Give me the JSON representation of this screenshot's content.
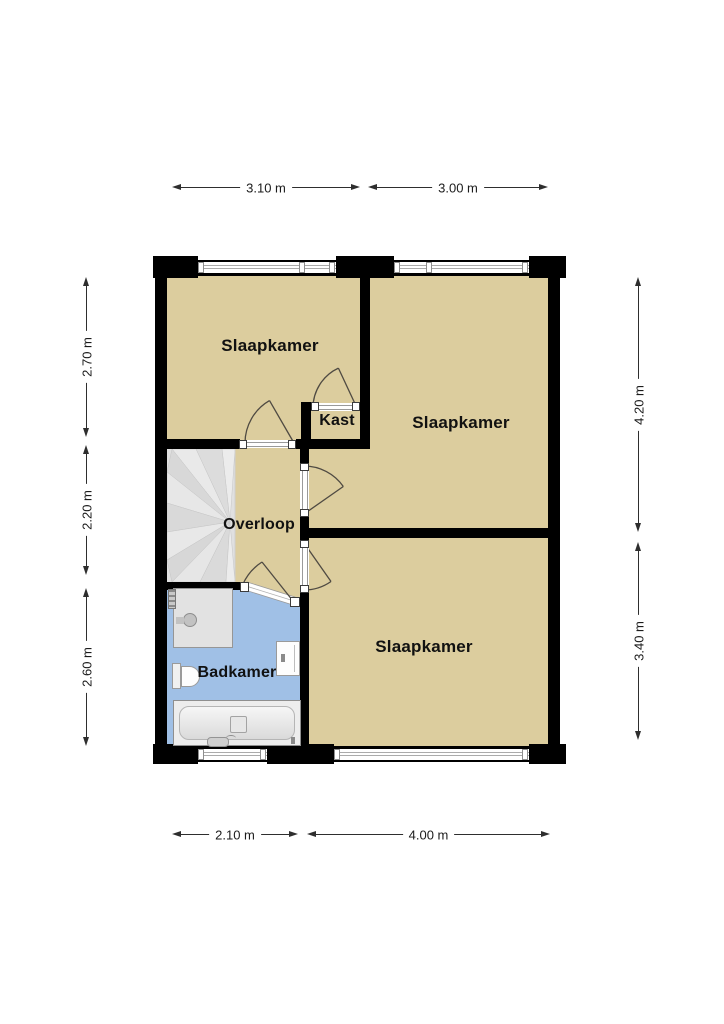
{
  "plan": {
    "rooms": [
      {
        "id": "slaapkamer-left",
        "label": "Slaapkamer"
      },
      {
        "id": "slaapkamer-right",
        "label": "Slaapkamer"
      },
      {
        "id": "slaapkamer-bottom",
        "label": "Slaapkamer"
      },
      {
        "id": "kast",
        "label": "Kast"
      },
      {
        "id": "overloop",
        "label": "Overloop"
      },
      {
        "id": "badkamer",
        "label": "Badkamer"
      }
    ],
    "dimensions": {
      "top": [
        "3.10 m",
        "3.00 m"
      ],
      "bottom": [
        "2.10 m",
        "4.00 m"
      ],
      "left": [
        "2.70 m",
        "2.20 m",
        "2.60 m"
      ],
      "right": [
        "4.20 m",
        "3.40 m"
      ]
    },
    "colors": {
      "floor": "#dccd9e",
      "bathroom_floor": "#a0c0e6",
      "wall": "#000000",
      "window_frame": "#ababab",
      "door_line": "#4f4a42",
      "stairs": "#e0e0e0"
    }
  }
}
